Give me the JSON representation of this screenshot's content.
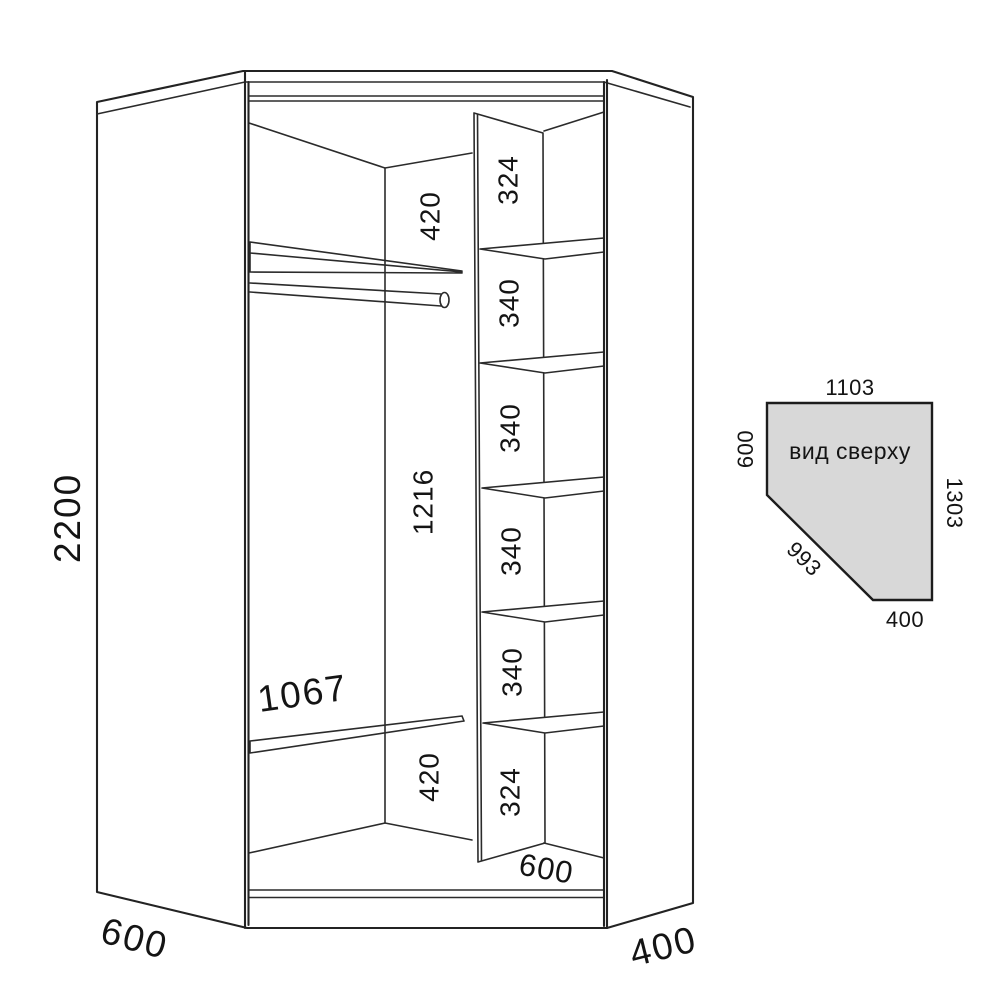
{
  "drawing_title": "corner wardrobe technical drawing",
  "front_view": {
    "dims": {
      "total_height": "2200",
      "top_section": "420",
      "middle_section": "1216",
      "shelf_length": "1067",
      "bottom_section": "420",
      "inner_bottom_width": "600",
      "left_side_depth": "600",
      "right_side_depth": "400",
      "column_sections": [
        "324",
        "340",
        "340",
        "340",
        "340",
        "324"
      ]
    }
  },
  "top_view": {
    "title": "вид сверху",
    "dims": {
      "top_width": "1103",
      "left_side": "600",
      "right_side": "1303",
      "diagonal": "993",
      "bottom_width": "400"
    },
    "fill_color": "#d8d8d8"
  },
  "colors": {
    "line": "#2b2b2b",
    "text": "#141414",
    "background": "#ffffff"
  }
}
